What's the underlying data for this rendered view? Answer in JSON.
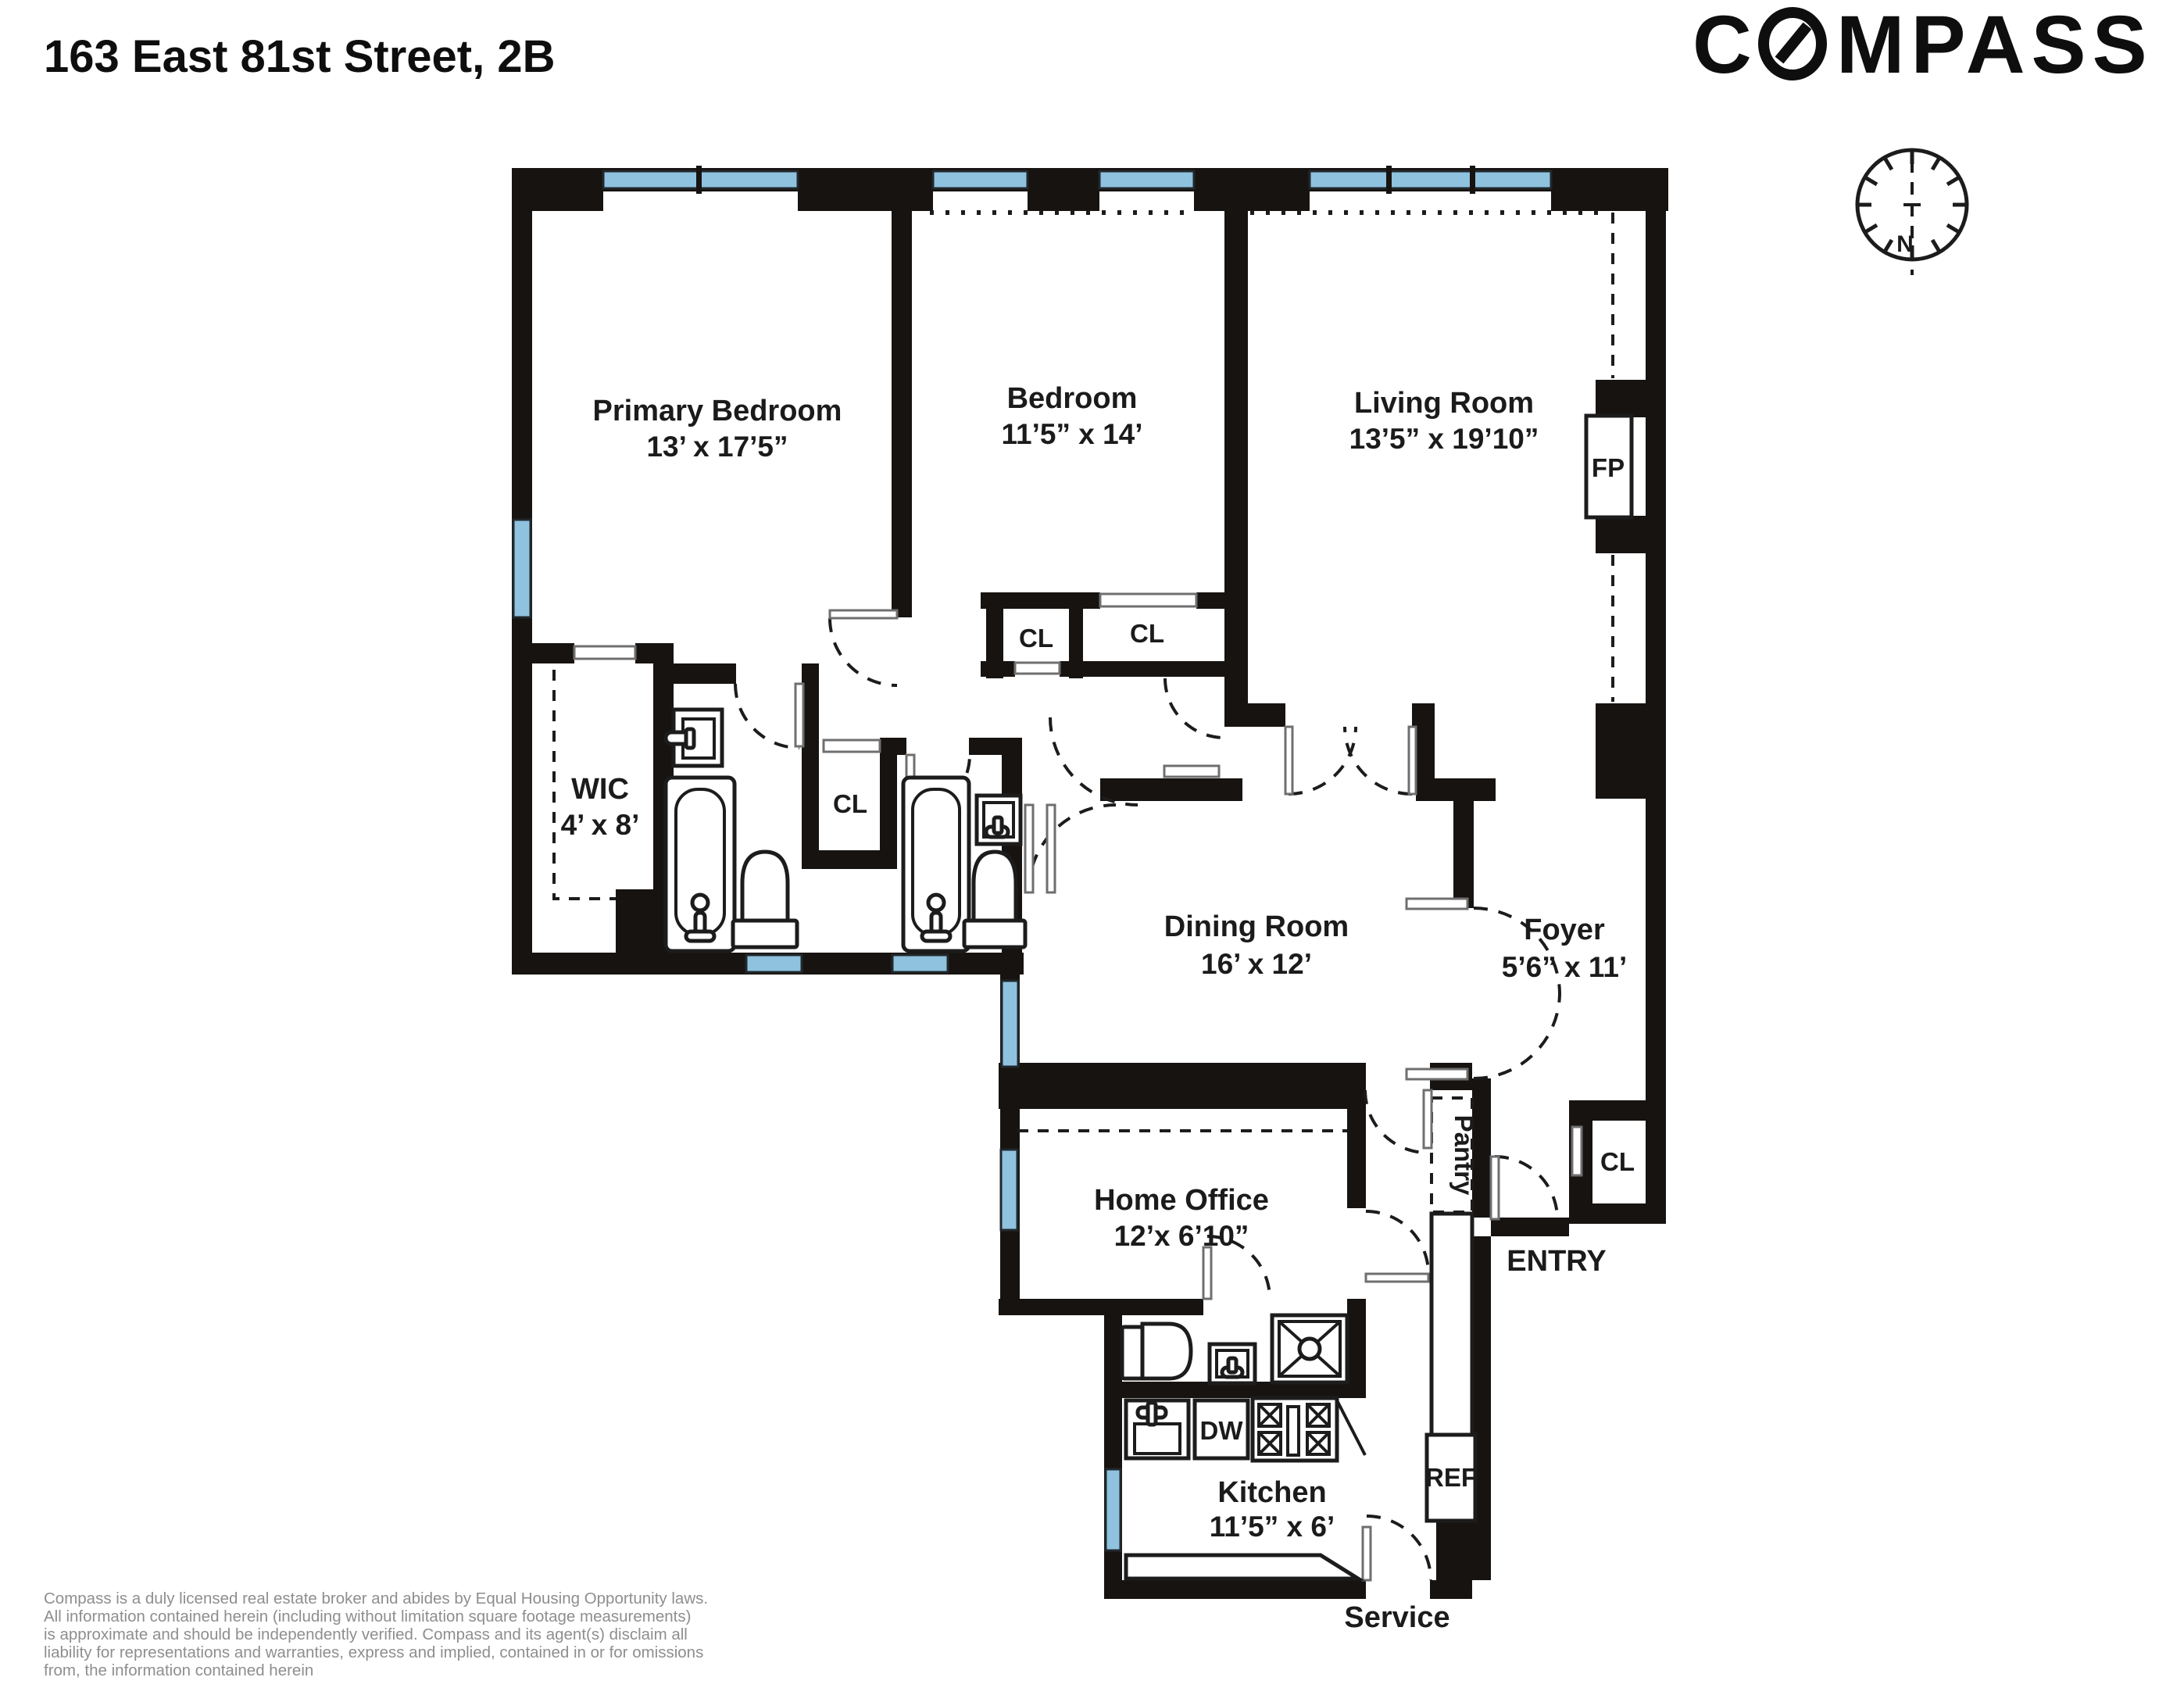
{
  "title": "163 East 81st Street, 2B",
  "logo": {
    "brand": "COMPASS",
    "part1": "C",
    "part2": "MPASS"
  },
  "compass_rose": {
    "north": "N"
  },
  "rooms": {
    "primary_bedroom": {
      "name": "Primary Bedroom",
      "dims": "13’ x 17’5”"
    },
    "bedroom": {
      "name": "Bedroom",
      "dims": "11’5” x 14’"
    },
    "living_room": {
      "name": "Living Room",
      "dims": "13’5” x 19’10”"
    },
    "wic": {
      "name": "WIC",
      "dims": "4’ x 8’"
    },
    "dining_room": {
      "name": "Dining Room",
      "dims": "16’ x 12’"
    },
    "foyer": {
      "name": "Foyer",
      "dims": "5’6” x 11’"
    },
    "home_office": {
      "name": "Home Office",
      "dims": "12’x 6’10”"
    },
    "kitchen": {
      "name": "Kitchen",
      "dims": "11’5” x 6’"
    }
  },
  "labels": {
    "closet": "CL",
    "fireplace": "FP",
    "dishwasher": "DW",
    "refrigerator": "REF",
    "pantry": "Pantry",
    "entry": "ENTRY",
    "service": "Service"
  },
  "colors": {
    "wall": "#171310",
    "window": "#8fc2df",
    "accent_text": "#1b1b1b",
    "disclaimer": "#8e8e8e"
  },
  "disclaimer": {
    "line1": "Compass is a duly licensed real estate broker and abides by Equal Housing Opportunity laws.",
    "line2": "All information contained herein (including without limitation square footage measurements)",
    "line3": " is approximate and should be independently verified. Compass and its agent(s) disclaim all",
    "line4": "liability for representations and warranties, express and implied, contained in or for omissions",
    "line5": " from, the information contained herein"
  }
}
